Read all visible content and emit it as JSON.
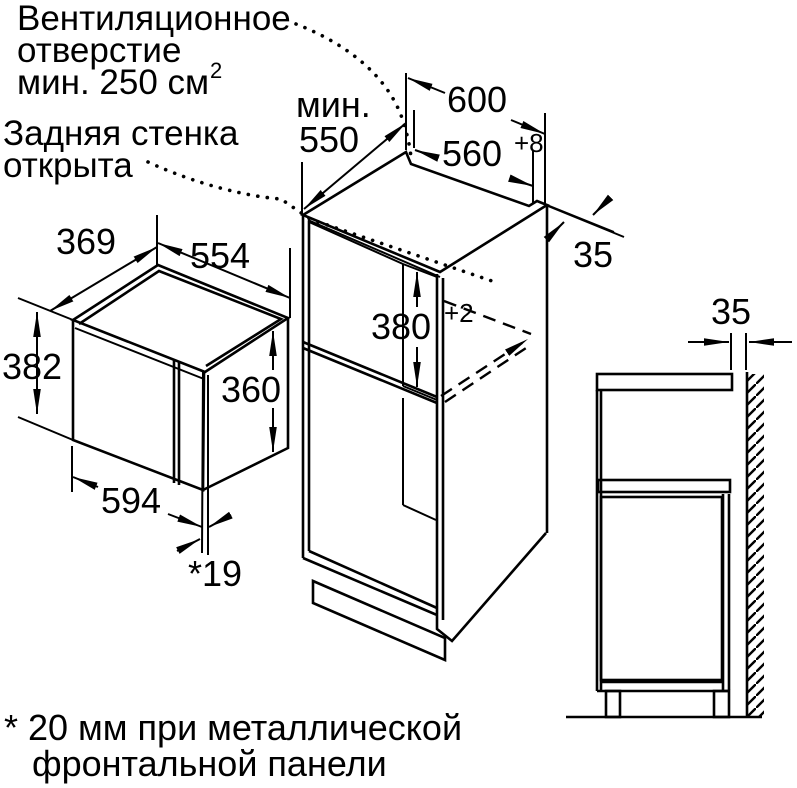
{
  "diagram": {
    "background": "#ffffff",
    "line_color": "#000000"
  },
  "notes": {
    "vent_line1": "Вентиляционное",
    "vent_line2": "отверстие",
    "vent_line3": "мин. 250 см",
    "vent_line3_sup": "2",
    "rear_line1": "Задняя стенка",
    "rear_line2": "открыта",
    "footnote_line1": "* 20 мм при металлической",
    "footnote_line2": "фронтальной панели"
  },
  "dimensions": {
    "min_label": "мин.",
    "min_depth": "550",
    "cabinet_width": "600",
    "niche_width": "560",
    "niche_width_tol": "+8",
    "rear_edge_gap": "35",
    "oven_depth": "369",
    "oven_top_width": "554",
    "oven_height": "382",
    "oven_side_height": "360",
    "niche_height": "380",
    "niche_height_tol": "+2",
    "oven_front_width": "594",
    "door_projection": "*19",
    "wall_clearance": "35"
  }
}
